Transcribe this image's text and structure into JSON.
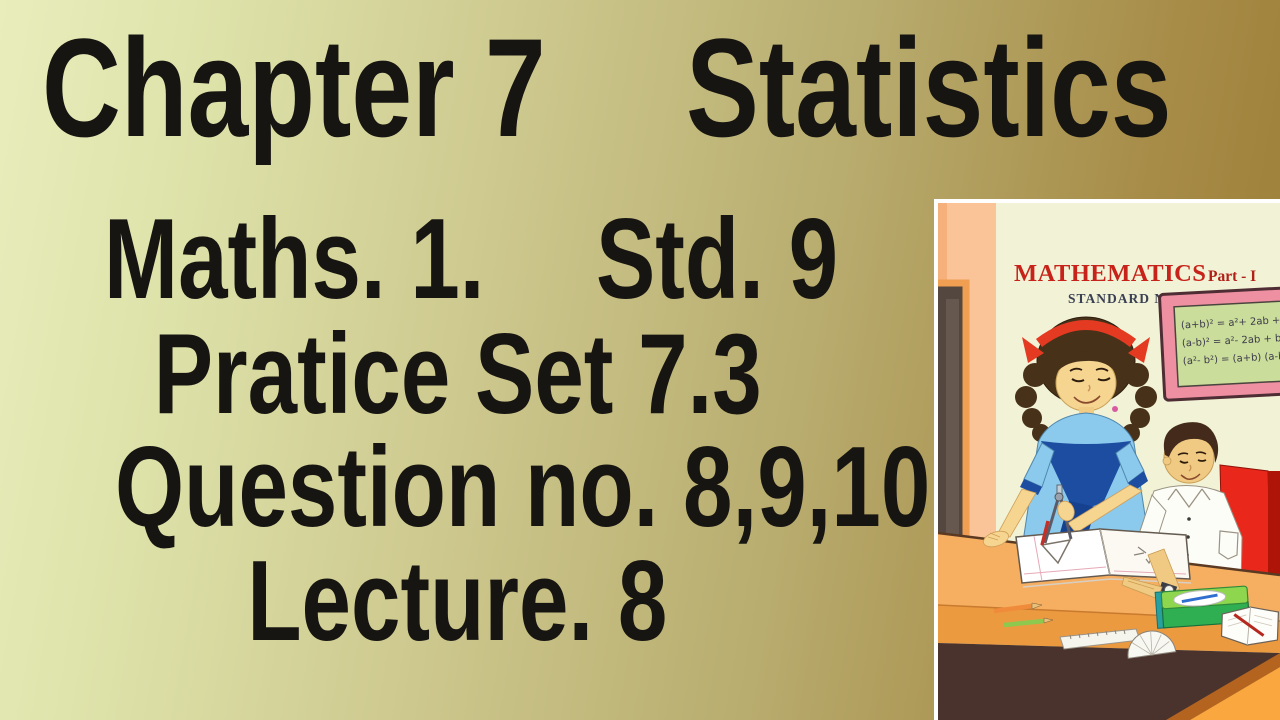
{
  "heading": {
    "left": "Chapter 7",
    "right": "Statistics"
  },
  "lines": {
    "subject": "Maths. 1.",
    "standard": "Std. 9",
    "practice_set": "Pratice Set 7.3",
    "questions": "Question no. 8,9,10",
    "lecture": "Lecture. 8"
  },
  "book_cover": {
    "title": "MATHEMATICS",
    "part": "Part - I",
    "standard": "STANDARD NINE",
    "board_formulas": [
      "(a+b)² = a²+ 2ab + b²",
      "(a-b)² = a²- 2ab + b²",
      "(a²- b²) = (a+b) (a-b)"
    ]
  },
  "colors": {
    "text": "#171512",
    "gradient_left": "#e9edbc",
    "gradient_right": "#9a7c33",
    "cover_title_red": "#c8231a",
    "cover_standard_navy": "#3a4053",
    "board_frame_pink": "#ee90a2",
    "board_surface_green": "#cadd9b",
    "desk_orange": "#f6ae60",
    "chair_red": "#e9281b"
  }
}
